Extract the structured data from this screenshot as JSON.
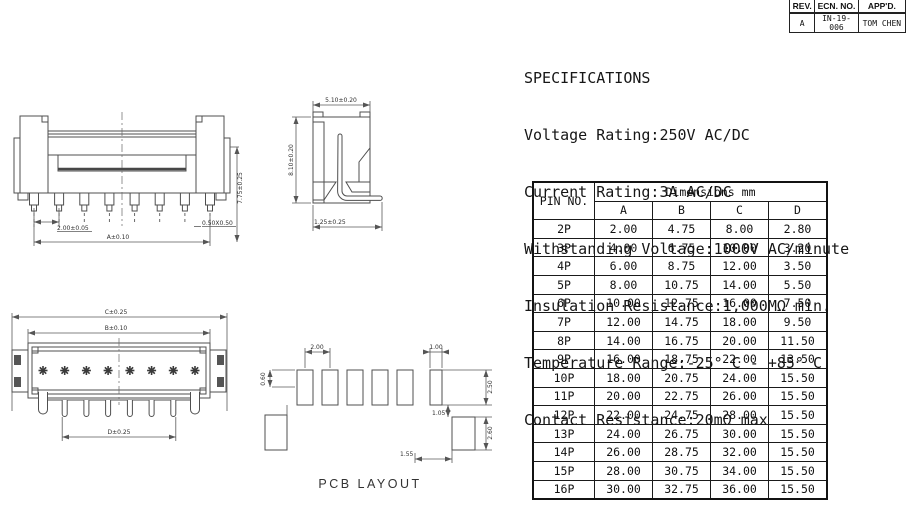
{
  "revision_block": {
    "headers": [
      "REV.",
      "ECN. NO.",
      "APP'D."
    ],
    "row": [
      "A",
      "IN-19-006",
      "TOM CHEN"
    ]
  },
  "specifications": {
    "title": "SPECIFICATIONS",
    "lines": [
      "Voltage Rating:250V AC/DC",
      "Current Rating:3A AC/DC",
      "Withstanding Voltage:1000V AC/minute",
      "Insulation Resistance:1,000MΩ min.",
      "Temperature Range:-25° C - +85° C",
      "Contact Resistance:20mΩ max"
    ]
  },
  "dimension_table": {
    "pin_header": "PIN NO.",
    "group_header": "Dimensions mm",
    "columns": [
      "A",
      "B",
      "C",
      "D"
    ],
    "rows": [
      [
        "2P",
        "2.00",
        "4.75",
        "8.00",
        "2.80"
      ],
      [
        "3P",
        "4.00",
        "6.75",
        "10.00",
        "3.20"
      ],
      [
        "4P",
        "6.00",
        "8.75",
        "12.00",
        "3.50"
      ],
      [
        "5P",
        "8.00",
        "10.75",
        "14.00",
        "5.50"
      ],
      [
        "6P",
        "10.00",
        "12.75",
        "16.00",
        "7.50"
      ],
      [
        "7P",
        "12.00",
        "14.75",
        "18.00",
        "9.50"
      ],
      [
        "8P",
        "14.00",
        "16.75",
        "20.00",
        "11.50"
      ],
      [
        "9P",
        "16.00",
        "18.75",
        "22.00",
        "13.50"
      ],
      [
        "10P",
        "18.00",
        "20.75",
        "24.00",
        "15.50"
      ],
      [
        "11P",
        "20.00",
        "22.75",
        "26.00",
        "15.50"
      ],
      [
        "12P",
        "22.00",
        "24.75",
        "28.00",
        "15.50"
      ],
      [
        "13P",
        "24.00",
        "26.75",
        "30.00",
        "15.50"
      ],
      [
        "14P",
        "26.00",
        "28.75",
        "32.00",
        "15.50"
      ],
      [
        "15P",
        "28.00",
        "30.75",
        "34.00",
        "15.50"
      ],
      [
        "16P",
        "30.00",
        "32.75",
        "36.00",
        "15.50"
      ]
    ]
  },
  "drawings": {
    "front_view": {
      "labels": {
        "pitch": "2.00±0.05",
        "overall_width": "A±0.10",
        "pin_tip": "0.50X0.50",
        "height": "7.75±0.25"
      }
    },
    "section_view": {
      "labels": {
        "width": "5.10±0.20",
        "height": "8.10±0.20",
        "lead": "1.25±0.25"
      }
    },
    "top_view": {
      "labels": {
        "overall_length": "C±0.25",
        "body_length": "B±0.10",
        "pin_span": "D±0.25"
      }
    },
    "pcb_layout": {
      "caption": "PCB LAYOUT",
      "labels": {
        "pad_pitch": "2.00",
        "pad_width": "0.60",
        "end_pad_width": "1.00",
        "pad_height": "2.50",
        "pad_gap": "1.05",
        "tab_pad_height": "2.60",
        "tab_offset": "1.55"
      }
    }
  }
}
